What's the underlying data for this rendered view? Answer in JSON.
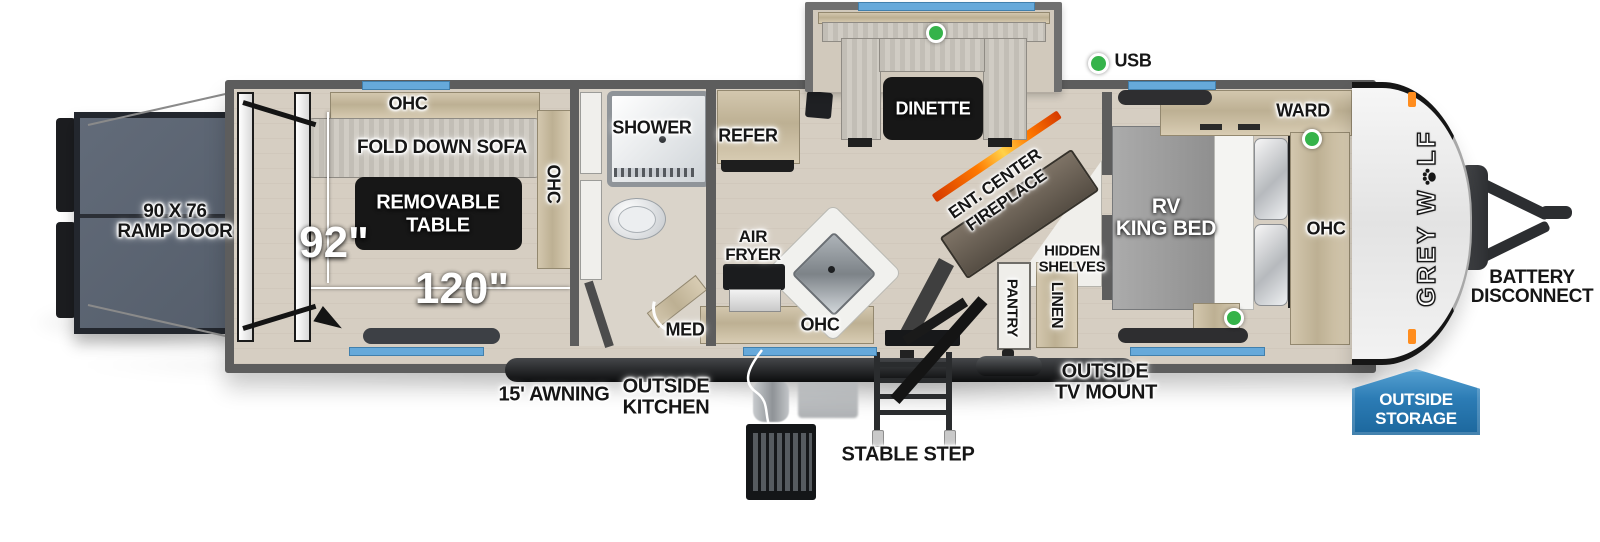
{
  "brand": {
    "logo_part1": "GREY W",
    "logo_part2": "LF"
  },
  "legend": {
    "usb": "USB"
  },
  "colors": {
    "window_blue": "#66a9da",
    "usb_green": "#35b34a",
    "badge_blue": "#2c7cb5",
    "fireplace_orange": "#ff7a00",
    "wall_gray": "#5d5d5d"
  },
  "labels": {
    "ramp_l1": "90 X 76",
    "ramp_l2": "RAMP DOOR",
    "garage_ohc_top": "OHC",
    "fold_down_sofa": "FOLD DOWN SOFA",
    "removable_table_l1": "REMOVABLE",
    "removable_table_l2": "TABLE",
    "garage_ohc_side": "OHC",
    "dim_width": "92\"",
    "dim_length": "120\"",
    "shower": "SHOWER",
    "med": "MED",
    "refer": "REFER",
    "air_fryer_l1": "AIR",
    "air_fryer_l2": "FRYER",
    "kitchen_ohc": "OHC",
    "dinette": "DINETTE",
    "ent_center_l1": "ENT. CENTER",
    "ent_center_l2": "FIREPLACE",
    "hidden_shelves_l1": "HIDDEN",
    "hidden_shelves_l2": "SHELVES",
    "pantry": "PANTRY",
    "linen": "LINEN",
    "rv_king_bed_l1": "RV",
    "rv_king_bed_l2": "KING BED",
    "ward": "WARD",
    "bedroom_ohc": "OHC",
    "awning": "15' AWNING",
    "outside_kitchen_l1": "OUTSIDE",
    "outside_kitchen_l2": "KITCHEN",
    "stable_step": "STABLE STEP",
    "tv_mount_l1": "OUTSIDE",
    "tv_mount_l2": "TV MOUNT",
    "battery_l1": "BATTERY",
    "battery_l2": "DISCONNECT",
    "storage_l1": "OUTSIDE",
    "storage_l2": "STORAGE"
  }
}
